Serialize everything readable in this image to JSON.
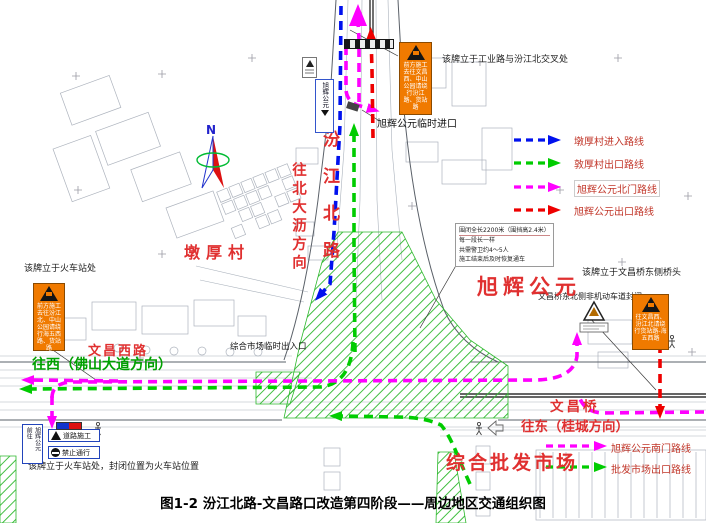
{
  "title": "图1-2 汾江北路-文昌路口改造第四阶段——周边地区交通组织图",
  "compass": {
    "n": "N"
  },
  "legend_top": {
    "items": [
      {
        "label": "墩厚村进入路线",
        "color": "#0011ee"
      },
      {
        "label": "敦厚村出口路线",
        "color": "#00cc00"
      },
      {
        "label": "旭辉公元北门路线",
        "color": "#ff00ff"
      },
      {
        "label": "旭辉公元出口路线",
        "color": "#ee0000"
      }
    ]
  },
  "legend_bottom": {
    "items": [
      {
        "label": "旭辉公元南门路线",
        "color": "#ff00ff"
      },
      {
        "label": "批发市场出口路线",
        "color": "#00cc00"
      }
    ]
  },
  "labels": {
    "dunhou_village": "墩厚村",
    "xuhui_gongyuan": "旭辉公元",
    "wenchang_west_road": "文昌西路",
    "to_west": "往西（佛山大道方向）",
    "wenchang_bridge": "文昌桥",
    "to_east": "往东（桂城方向）",
    "wholesale_market": "综合批发市场",
    "to_north_dali": "往北大沥方向",
    "fenjiang_north_road": "汾江北路",
    "market_temp_entrance": "综合市场临时出入口",
    "xuhui_temp_entrance": "旭辉公元临时进口",
    "bike_lane_closed": "文昌桥东北侧非机动车道封闭"
  },
  "captions": {
    "sign_top_location": "该牌立于工业路与汾江北交叉处",
    "sign_left_location": "该牌立于火车站处",
    "sign_right_location": "该牌立于文昌桥东侧桥头",
    "sign_station_closure": "该牌立于火车站处，封闭位置为火车站位置"
  },
  "signs": {
    "orange_top_text": "前方施工去往文昌西、中山公园请绕行汾江路、货站路",
    "orange_left_text": "前方施工去往汾江北、中山公园请绕行海五西路、货站路",
    "orange_right_text": "往文昌西、汾江北请绕行货站路-海五西路",
    "road_construction": "道路施工",
    "no_passing": "禁止通行",
    "vertical_sign_col1": "前往",
    "vertical_sign_col2": "旭辉公元",
    "blue_box_text": "旭辉公元"
  },
  "callout": {
    "lines": [
      "围闭全长2200米（围挡高2.4米）",
      "每一段长一样",
      "共需警卫约4～5人",
      "施工结束后及时恢复通车"
    ]
  }
}
